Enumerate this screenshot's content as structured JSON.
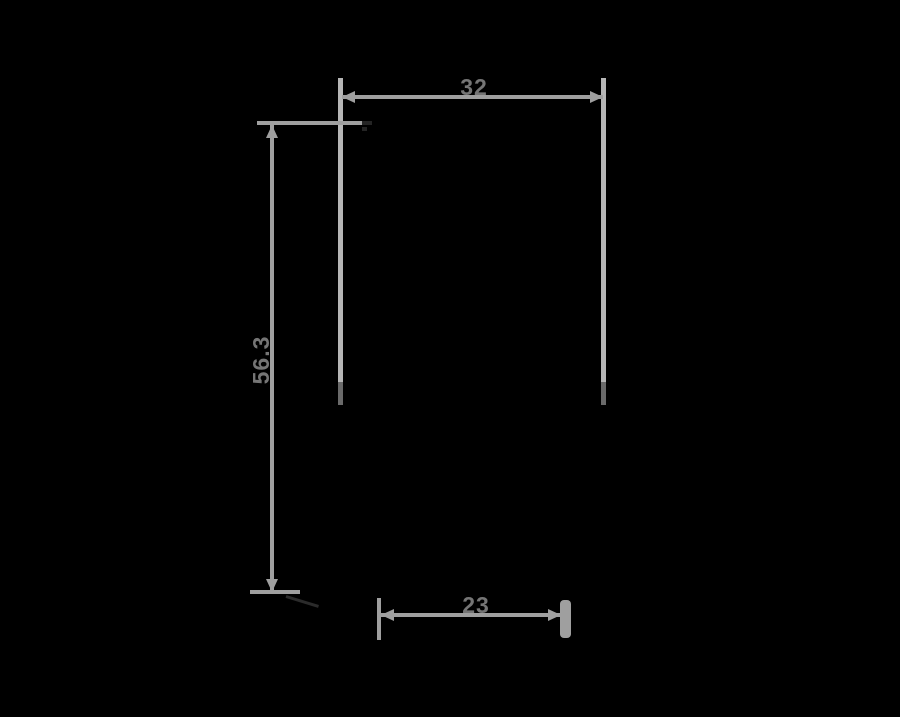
{
  "diagram": {
    "type": "product-dimension-drawing",
    "background_color": "#000000",
    "line_color": "#9f9f9f",
    "extension_line_color": "#b6b6b6",
    "label_color": "#757575",
    "dimensions": {
      "width": {
        "label": "32",
        "orientation": "horizontal",
        "position": "top"
      },
      "height": {
        "label": "56.3",
        "orientation": "vertical",
        "position": "left"
      },
      "depth": {
        "label": "23",
        "orientation": "horizontal",
        "position": "bottom"
      }
    }
  }
}
